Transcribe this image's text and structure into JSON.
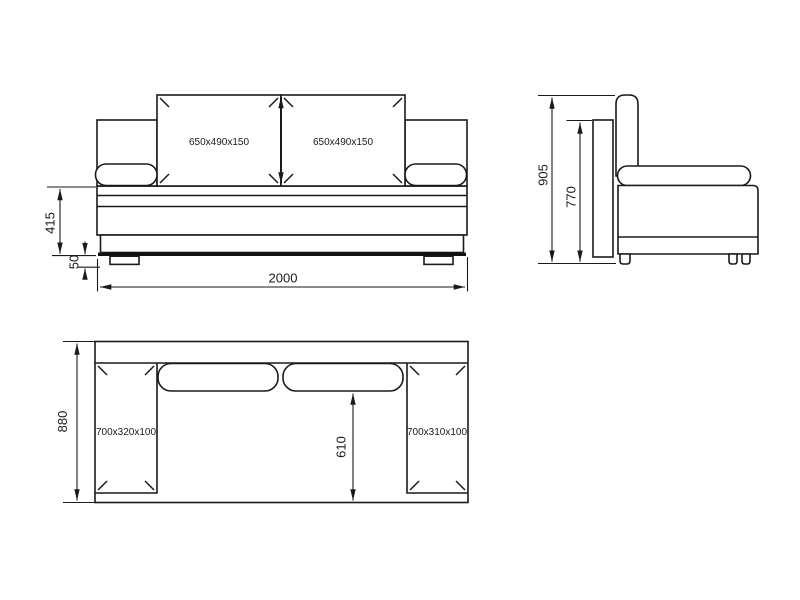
{
  "colors": {
    "line": "#1a1a1a",
    "thick_line": "#111111",
    "background": "#ffffff"
  },
  "views": {
    "front": {
      "cushion_left": "650x490x150",
      "cushion_right": "650x490x150",
      "dim_seat_height": "415",
      "dim_leg_height": "50",
      "dim_width": "2000"
    },
    "side": {
      "dim_total_height": "905",
      "dim_back_height": "770"
    },
    "top": {
      "armrest_left": "700x320x100",
      "armrest_right": "700x310x100",
      "dim_depth": "880",
      "dim_seat_depth": "610"
    }
  }
}
